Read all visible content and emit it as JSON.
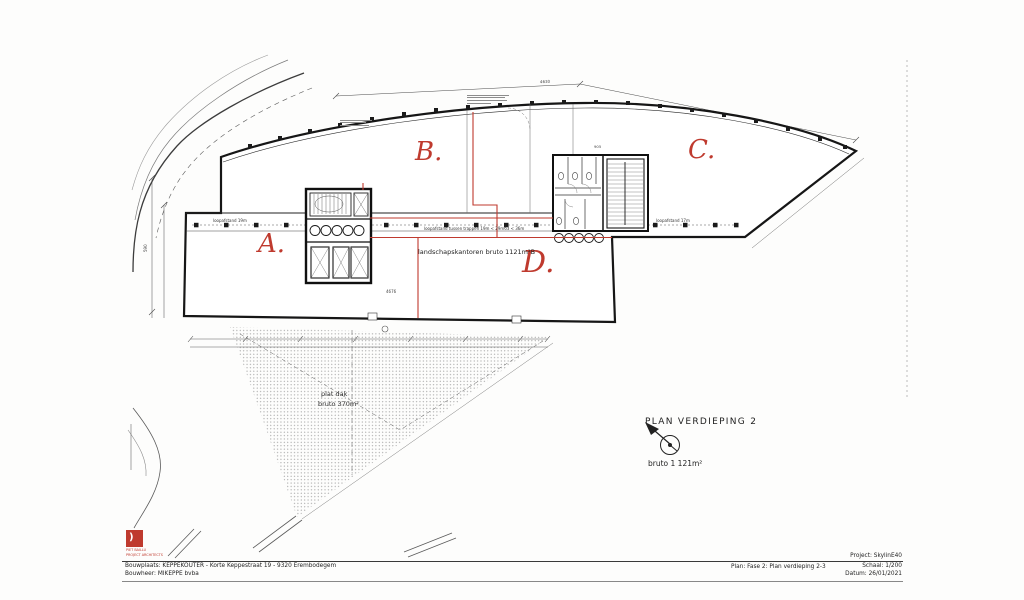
{
  "colors": {
    "accent_red": "#bf3a2e",
    "ink": "#1f1f1f"
  },
  "drawing": {
    "zone_a": "A.",
    "zone_b": "B.",
    "zone_c": "C.",
    "zone_d": "D.",
    "office_label": "landschapskantoren bruto 1121m²B",
    "roof_line1": "plat dak",
    "roof_line2": "bruto 370m²",
    "dist_left": "loopafstand 19m",
    "dist_mid": "loopafstand tussen trappen 19m < 29m63 < 36m",
    "dist_right": "loopafstand 17m",
    "dim_top": "4630",
    "dim_bottom": "4676",
    "dim_left": "590",
    "dim_core": "905"
  },
  "legend": {
    "title": "PLAN  VERDIEPING 2",
    "area": "bruto 1 121m²"
  },
  "title_block": {
    "logo_glyph": ")",
    "logo_line1": "PIET BAILLU",
    "logo_line2": "PROJECT ARCHITECTS",
    "site": "Bouwplaats: KEPPEKOUTER - Korte Keppestraat 19 - 9320 Erembodegem",
    "client": "Bouwheer: MIKEPPE bvba",
    "project": "Project: SkylinE40",
    "plan": "Plan: Fase 2: Plan verdieping 2-3",
    "scale": "Schaal: 1/200",
    "date": "Datum: 26/01/2021"
  }
}
